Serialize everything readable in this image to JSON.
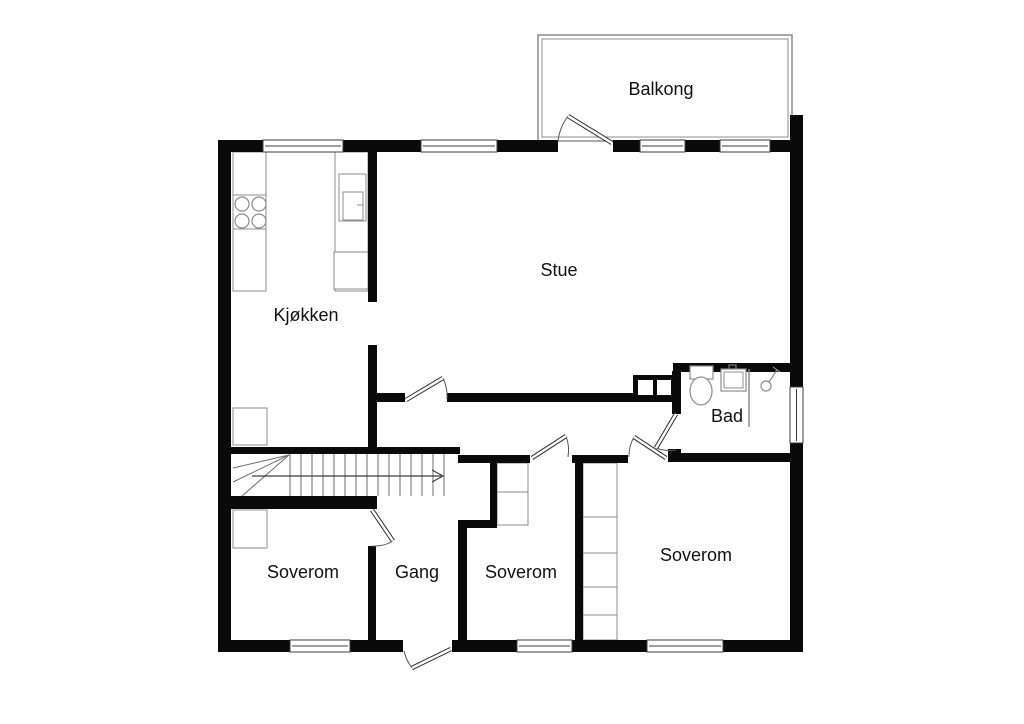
{
  "plan": {
    "canvas": {
      "w": 1024,
      "h": 724
    },
    "colors": {
      "wall": "#0a0a0a",
      "background": "#ffffff",
      "furniture_line": "#8c8c8c",
      "door_line": "#2b2b2b",
      "arc_line": "#555555",
      "window_frame": "#3c3c3c",
      "stair_line": "#6e6e6e",
      "label_text": "#111111"
    },
    "labels": [
      {
        "id": "balkong",
        "text": "Balkong",
        "x": 661,
        "y": 90
      },
      {
        "id": "stue",
        "text": "Stue",
        "x": 559,
        "y": 271
      },
      {
        "id": "kjokken",
        "text": "Kjøkken",
        "x": 306,
        "y": 316
      },
      {
        "id": "bad",
        "text": "Bad",
        "x": 727,
        "y": 417
      },
      {
        "id": "soverom-1",
        "text": "Soverom",
        "x": 303,
        "y": 573
      },
      {
        "id": "gang",
        "text": "Gang",
        "x": 417,
        "y": 573
      },
      {
        "id": "soverom-2",
        "text": "Soverom",
        "x": 521,
        "y": 573
      },
      {
        "id": "soverom-3",
        "text": "Soverom",
        "x": 696,
        "y": 556
      }
    ],
    "label_font_px": 18,
    "walls": [
      [
        218,
        140,
        13,
        512
      ],
      [
        218,
        140,
        340,
        12
      ],
      [
        613,
        140,
        190,
        12
      ],
      [
        790,
        115,
        13,
        537
      ],
      [
        218,
        640,
        185,
        12
      ],
      [
        452,
        640,
        351,
        12
      ],
      [
        368,
        152,
        9,
        150
      ],
      [
        368,
        345,
        9,
        109
      ],
      [
        375,
        393,
        30,
        9
      ],
      [
        447,
        393,
        186,
        9
      ],
      [
        673,
        363,
        117,
        9
      ],
      [
        672,
        371,
        9,
        43
      ],
      [
        672,
        449,
        9,
        9
      ],
      [
        672,
        453,
        118,
        9
      ],
      [
        231,
        447,
        229,
        7
      ],
      [
        231,
        496,
        146,
        13
      ],
      [
        368,
        546,
        8,
        94
      ],
      [
        458,
        455,
        72,
        8
      ],
      [
        490,
        463,
        7,
        57
      ],
      [
        458,
        520,
        39,
        8
      ],
      [
        458,
        528,
        9,
        112
      ],
      [
        575,
        455,
        8,
        185
      ],
      [
        572,
        455,
        56,
        8
      ],
      [
        668,
        449,
        13,
        13
      ]
    ],
    "windows": [
      [
        263,
        140,
        80,
        12,
        "h"
      ],
      [
        421,
        140,
        76,
        12,
        "h"
      ],
      [
        640,
        140,
        45,
        12,
        "h"
      ],
      [
        720,
        140,
        50,
        12,
        "h"
      ],
      [
        290,
        640,
        60,
        12,
        "h"
      ],
      [
        517,
        640,
        55,
        12,
        "h"
      ],
      [
        647,
        640,
        76,
        12,
        "h"
      ],
      [
        790,
        387,
        13,
        56,
        "v"
      ]
    ],
    "doors": [
      {
        "id": "balcony-door",
        "leaf": [
          612,
          143,
          568,
          116
        ],
        "arc": "M568,116 A53,53 0 0 0 558,141"
      },
      {
        "id": "stue-door",
        "leaf": [
          406,
          400,
          443,
          378
        ],
        "arc": "M443,378 A43,43 0 0 1 447,399"
      },
      {
        "id": "soverom2-door",
        "leaf": [
          532,
          458,
          566,
          436
        ],
        "arc": "M566,436 A40,40 0 0 1 568,457"
      },
      {
        "id": "soverom3-door",
        "leaf": [
          666,
          458,
          634,
          437
        ],
        "arc": "M634,437 A38,38 0 0 0 629,457"
      },
      {
        "id": "bad-door",
        "leaf": [
          676,
          414,
          656,
          448
        ],
        "arc": "M656,448 A39,39 0 0 0 676,450"
      },
      {
        "id": "soverom1-door",
        "leaf": [
          372,
          510,
          393,
          541
        ],
        "arc": "M393,541 A37,37 0 0 1 372,546"
      },
      {
        "id": "entrance-door",
        "leaf": [
          451,
          649,
          412,
          668
        ],
        "arc": "M412,668 A44,44 0 0 1 404,651"
      }
    ],
    "balcony": {
      "outer": [
        538,
        35,
        254,
        106
      ],
      "inner": [
        542,
        39,
        246,
        98
      ]
    },
    "chimney": {
      "body": [
        633,
        375,
        42,
        27
      ],
      "flues": [
        [
          638,
          380,
          15,
          15
        ],
        [
          657,
          380,
          14,
          15
        ]
      ]
    },
    "stairs": {
      "tread_x": [
        290,
        301,
        312,
        323,
        334,
        345,
        356,
        367,
        378,
        389,
        400,
        411,
        422,
        433,
        444
      ],
      "tread_y1": 454,
      "tread_y2": 496,
      "winders": [
        [
          233,
          468,
          289,
          455
        ],
        [
          233,
          482,
          289,
          455
        ],
        [
          242,
          496,
          289,
          455
        ]
      ],
      "arrow_shaft": [
        252,
        476,
        441,
        476
      ],
      "arrow_head": [
        [
          432,
          470
        ],
        [
          443,
          476
        ],
        [
          432,
          482
        ]
      ]
    },
    "furniture_rects": [
      [
        233,
        152,
        33,
        139
      ],
      [
        233,
        195,
        33,
        34
      ],
      [
        335,
        152,
        33,
        139
      ],
      [
        339,
        174,
        27,
        47
      ],
      [
        343,
        192,
        20,
        28
      ],
      [
        334,
        252,
        34,
        37
      ],
      [
        233,
        408,
        34,
        37
      ],
      [
        233,
        510,
        34,
        38
      ],
      [
        497,
        463,
        31,
        62
      ],
      [
        583,
        463,
        34,
        177
      ]
    ],
    "furniture_lines": [
      [
        497,
        492,
        528,
        492
      ],
      [
        583,
        517,
        617,
        517
      ],
      [
        583,
        553,
        617,
        553
      ],
      [
        583,
        587,
        617,
        587
      ],
      [
        583,
        615,
        617,
        615
      ],
      [
        357,
        205,
        363,
        205
      ]
    ],
    "stove_burners": {
      "centers": [
        [
          242,
          204
        ],
        [
          259,
          204
        ],
        [
          242,
          221
        ],
        [
          259,
          221
        ]
      ],
      "r": 7
    },
    "bath": {
      "toilet_tank": [
        690,
        366,
        23,
        13
      ],
      "toilet_bowl": {
        "cx": 701,
        "cy": 391,
        "rx": 11,
        "ry": 14
      },
      "sink_outer": [
        721,
        369,
        25,
        22
      ],
      "sink_inner": [
        724,
        372,
        19,
        16
      ],
      "sink_tap": [
        729,
        365,
        7,
        4
      ],
      "shower_circle": {
        "cx": 766,
        "cy": 386,
        "r": 5
      },
      "shower_arm": [
        769,
        382,
        777,
        370
      ],
      "shower_bar": [
        773,
        367,
        780,
        372
      ],
      "partition": [
        749,
        369,
        749,
        427
      ]
    }
  }
}
